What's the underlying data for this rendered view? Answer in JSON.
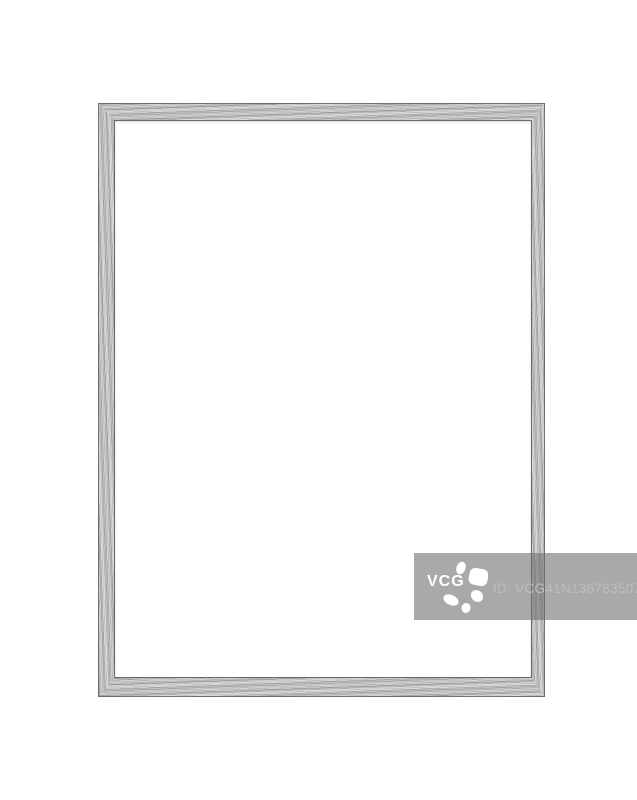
{
  "watermark": {
    "logo_text": "VCG",
    "id_text": "ID: VCG41N1367835078",
    "flower_icon": "vcg-flower-icon"
  },
  "colors": {
    "background": "#ffffff",
    "frame-base": "#c3c3c3",
    "frame-edge": "#5a5a5a",
    "frame-inner-edge": "#4f4f4f",
    "watermark-bar": "rgba(112,112,112,0.6)",
    "watermark-text": "#bdbdbd",
    "watermark-logo": "#ffffff"
  }
}
